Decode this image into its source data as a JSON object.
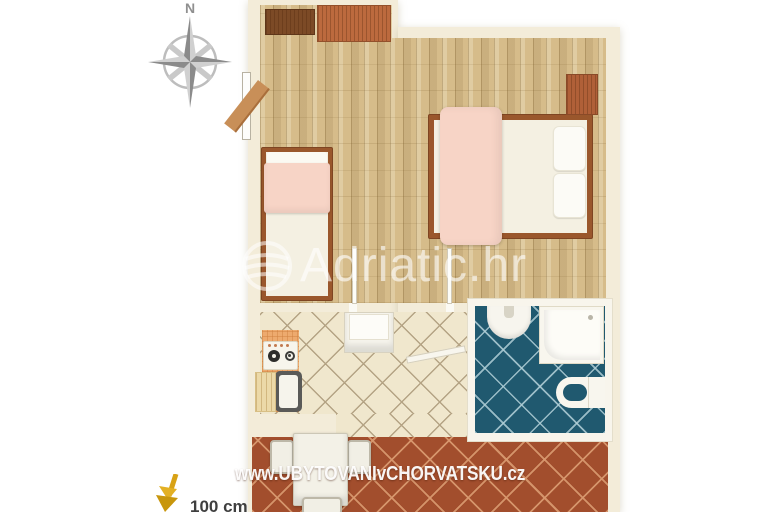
{
  "compass": {
    "label": "N"
  },
  "watermarks": {
    "center_logo_text": "Adriatic.hr",
    "bottom_url": "www.UBYTOVANIvCHORVATSKU.cz"
  },
  "scale_indicator": {
    "label": "100 cm"
  },
  "palette": {
    "plan_margin": "#f3ecd9",
    "wood_floor": "#d6bc8a",
    "kitchen_tile": "#f0e7cd",
    "kitchen_grout": "#b4a384",
    "bathroom_tile": "#20596f",
    "terrace_tile": "#a24e2d",
    "wardrobe_dark": "#7c4a26",
    "wardrobe_red": "#bc6a3e",
    "bed_frame": "#9a572c",
    "blanket_pink": "#f7d4c6",
    "linen_white": "#f4f0e2",
    "counter_orange": "#edaa6e",
    "fixture_white": "#f8f5ec",
    "scale_arrow_gold": "#d8a215",
    "compass_gray": "#9a9a9a"
  }
}
